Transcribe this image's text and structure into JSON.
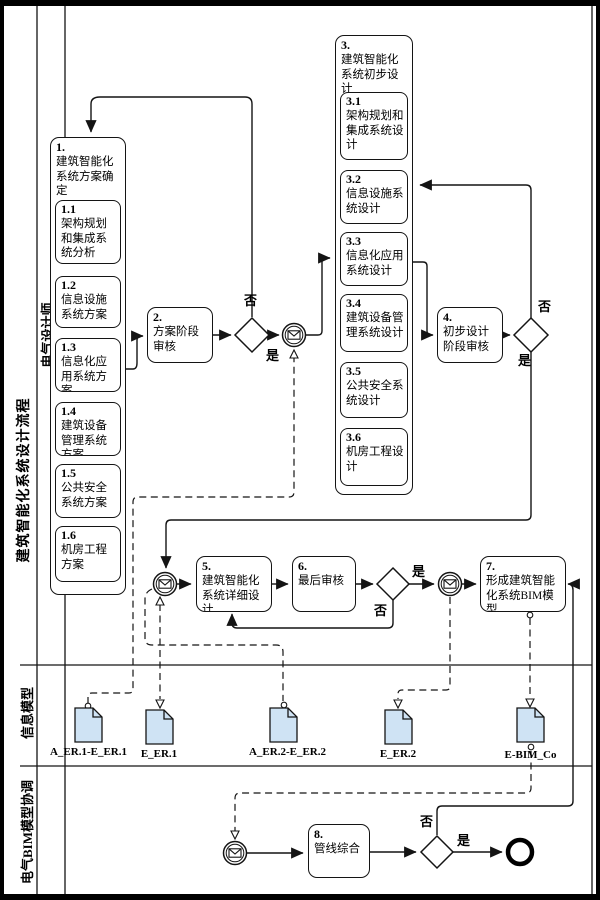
{
  "pool": {
    "title": "建筑智能化系统设计流程"
  },
  "lanes": {
    "designer": "电气设计师",
    "info_model": "信息模型",
    "bim_coord": "电气BIM模型协调"
  },
  "decisions": {
    "yes": "是",
    "no": "否"
  },
  "activities": {
    "a1": {
      "num": "1.",
      "label": "建筑智能化系统方案确定"
    },
    "a1_1": {
      "num": "1.1",
      "label": "架构规划和集成系统分析"
    },
    "a1_2": {
      "num": "1.2",
      "label": "信息设施系统方案"
    },
    "a1_3": {
      "num": "1.3",
      "label": "信息化应用系统方案"
    },
    "a1_4": {
      "num": "1.4",
      "label": "建筑设备管理系统方案"
    },
    "a1_5": {
      "num": "1.5",
      "label": "公共安全系统方案"
    },
    "a1_6": {
      "num": "1.6",
      "label": "机房工程方案"
    },
    "a2": {
      "num": "2.",
      "label": "方案阶段审核"
    },
    "a3": {
      "num": "3.",
      "label": "建筑智能化系统初步设计"
    },
    "a3_1": {
      "num": "3.1",
      "label": "架构规划和集成系统设计"
    },
    "a3_2": {
      "num": "3.2",
      "label": "信息设施系统设计"
    },
    "a3_3": {
      "num": "3.3",
      "label": "信息化应用系统设计"
    },
    "a3_4": {
      "num": "3.4",
      "label": "建筑设备管理系统设计"
    },
    "a3_5": {
      "num": "3.5",
      "label": "公共安全系统设计"
    },
    "a3_6": {
      "num": "3.6",
      "label": "机房工程设计"
    },
    "a4": {
      "num": "4.",
      "label": "初步设计阶段审核"
    },
    "a5": {
      "num": "5.",
      "label": "建筑智能化系统详细设计"
    },
    "a6": {
      "num": "6.",
      "label": "最后审核"
    },
    "a7": {
      "num": "7.",
      "label": "形成建筑智能化系统BIM模型"
    },
    "a8": {
      "num": "8.",
      "label": "管线综合"
    }
  },
  "documents": {
    "d1": {
      "label": "A_ER.1-E_ER.1"
    },
    "d2": {
      "label": "E_ER.1"
    },
    "d3": {
      "label": "A_ER.2-E_ER.2"
    },
    "d4": {
      "label": "E_ER.2"
    },
    "d5": {
      "label": "E-BIM_Co"
    }
  },
  "colors": {
    "line": "#141414",
    "document_fill": "#cfe3f4"
  }
}
